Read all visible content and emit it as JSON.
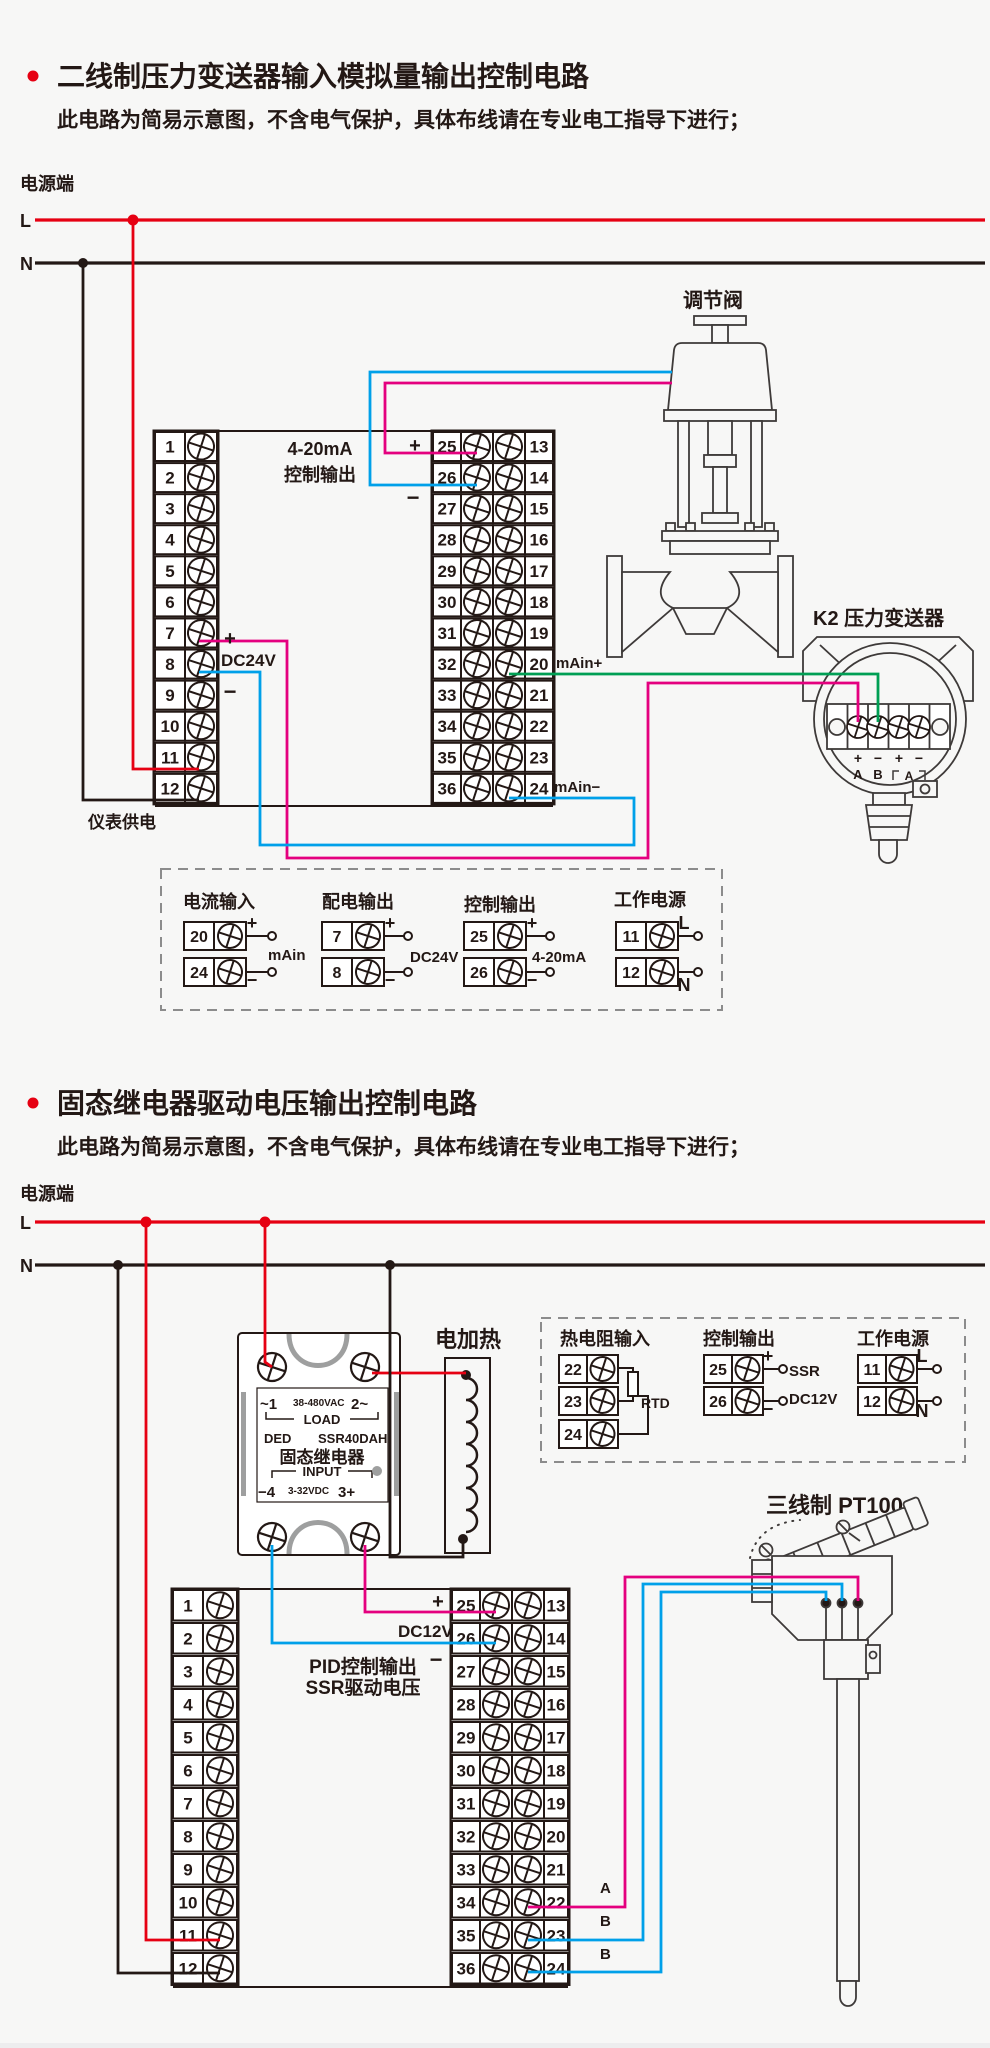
{
  "colors": {
    "red": "#e60012",
    "magenta": "#e4007f",
    "blue": "#00a0e9",
    "green": "#009f54",
    "ink": "#231815",
    "gray": "#9e9f9f"
  },
  "s1": {
    "title": "二线制压力变送器输入模拟量输出控制电路",
    "subtitle": "此电路为简易示意图，不含电气保护，具体布线请在专业电工指导下进行；",
    "power": {
      "label": "电源端",
      "l": "L",
      "n": "N"
    },
    "meter_supply": "仪表供电",
    "instrument": {
      "left_nums": [
        "1",
        "2",
        "3",
        "4",
        "5",
        "6",
        "7",
        "8",
        "9",
        "10",
        "11",
        "12"
      ],
      "mid_left_nums": [
        "25",
        "26",
        "27",
        "28",
        "29",
        "30",
        "31",
        "32",
        "33",
        "34",
        "35",
        "36"
      ],
      "mid_right_nums": [
        "13",
        "14",
        "15",
        "16",
        "17",
        "18",
        "19",
        "20",
        "21",
        "22",
        "23",
        "24"
      ],
      "output_line1": "4-20mA",
      "output_line2": "控制输出",
      "plus": "+",
      "minus": "−",
      "dc24v": "DC24V",
      "main_plus": "mAin+",
      "main_minus": "mAin−"
    },
    "valve_label": "调节阀",
    "transmitter": {
      "label": "K2 压力变送器",
      "terms": [
        "+",
        "−",
        "+",
        "−"
      ],
      "ab": [
        "A",
        "B"
      ],
      "loop": "A"
    },
    "legend": {
      "groups": [
        {
          "title": "电流输入",
          "rows": [
            {
              "n": "20",
              "tag": "+"
            },
            {
              "n": "24",
              "tag": "−"
            }
          ],
          "side": "mAin"
        },
        {
          "title": "配电输出",
          "rows": [
            {
              "n": "7",
              "tag": "+"
            },
            {
              "n": "8",
              "tag": "−"
            }
          ],
          "side": "DC24V"
        },
        {
          "title": "控制输出",
          "rows": [
            {
              "n": "25",
              "tag": "+"
            },
            {
              "n": "26",
              "tag": "−"
            }
          ],
          "side": "4-20mA"
        },
        {
          "title": "工作电源",
          "rows": [
            {
              "n": "11",
              "tag": "L"
            },
            {
              "n": "12",
              "tag": "N"
            }
          ],
          "side": ""
        }
      ]
    }
  },
  "s2": {
    "title": "固态继电器驱动电压输出控制电路",
    "subtitle": "此电路为简易示意图，不含电气保护，具体布线请在专业电工指导下进行；",
    "power": {
      "label": "电源端",
      "l": "L",
      "n": "N"
    },
    "heater_label": "电加热",
    "pt100_label": "三线制 PT100",
    "ssr": {
      "t1": "~1",
      "vac": "38-480VAC",
      "t2": "2~",
      "load": "LOAD",
      "brand": "DED",
      "model": "SSR40DAH",
      "name": "固态继电器",
      "input": "INPUT",
      "t4": "−4",
      "vdc": "3-32VDC",
      "t3": "3+"
    },
    "instrument": {
      "left_nums": [
        "1",
        "2",
        "3",
        "4",
        "5",
        "6",
        "7",
        "8",
        "9",
        "10",
        "11",
        "12"
      ],
      "mid_left_nums": [
        "25",
        "26",
        "27",
        "28",
        "29",
        "30",
        "31",
        "32",
        "33",
        "34",
        "35",
        "36"
      ],
      "mid_right_nums": [
        "13",
        "14",
        "15",
        "16",
        "17",
        "18",
        "19",
        "20",
        "21",
        "22",
        "23",
        "24"
      ],
      "plus": "+",
      "minus": "−",
      "dc12v": "DC12V",
      "pid1": "PID控制输出",
      "pid2": "SSR驱动电压",
      "wire_a": "A",
      "wire_b1": "B",
      "wire_b2": "B"
    },
    "legend": {
      "groups": [
        {
          "title": "热电阻输入",
          "rows": [
            {
              "n": "22",
              "tag": ""
            },
            {
              "n": "23",
              "tag": ""
            },
            {
              "n": "24",
              "tag": ""
            }
          ],
          "side": "RTD"
        },
        {
          "title": "控制输出",
          "rows": [
            {
              "n": "25",
              "tag": "+"
            },
            {
              "n": "26",
              "tag": "−"
            }
          ],
          "side": "SSR",
          "side2": "DC12V"
        },
        {
          "title": "工作电源",
          "rows": [
            {
              "n": "11",
              "tag": "L"
            },
            {
              "n": "12",
              "tag": "N"
            }
          ],
          "side": ""
        }
      ]
    }
  }
}
